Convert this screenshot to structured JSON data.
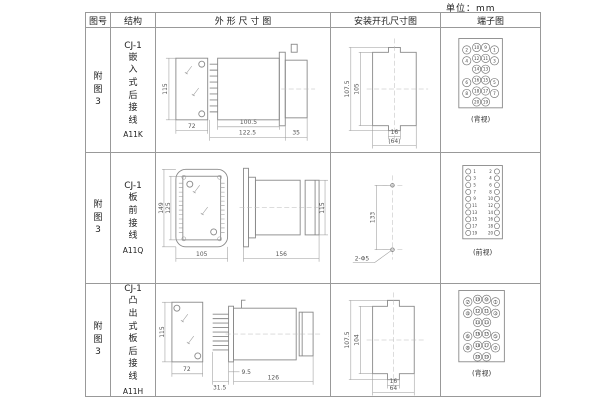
{
  "unit_label": "单位：mm",
  "table": {
    "headers": {
      "fig_no": "图号",
      "structure": "结构",
      "outline": "外 形 尺 寸 图",
      "install": "安装开孔尺寸图",
      "terminal": "端子图"
    },
    "rows": [
      {
        "fig_no": "附图3",
        "model": "CJ-1",
        "structure_desc": "嵌入式后接线",
        "code": "A11K",
        "outline": {
          "front_h": "115",
          "front_w": "72",
          "body_d": "100.5",
          "total_d": "122.5",
          "rear_d": "35"
        },
        "install": {
          "outer_h": "107.5",
          "inner_h": "105",
          "slot_w": "16",
          "cutout_w": "(64)"
        },
        "terminal": {
          "view_label": "(背视)",
          "type": "staggered",
          "screw": false,
          "rows": [
            [
              "2",
              "10",
              "9",
              "1"
            ],
            [
              "4",
              "12",
              "11",
              "3"
            ],
            [
              "",
              "14",
              "13",
              ""
            ],
            [
              "6",
              "16",
              "15",
              "5"
            ],
            [
              "8",
              "18",
              "17",
              "7"
            ],
            [
              "",
              "20",
              "19",
              ""
            ]
          ]
        }
      },
      {
        "fig_no": "附图3",
        "model": "CJ-1",
        "structure_desc": "板前接线",
        "code": "A11Q",
        "outline": {
          "front_outer_h": "149",
          "front_inner_h": "125",
          "front_w": "105",
          "side_l": "156",
          "side_h": "115"
        },
        "install": {
          "hole_spacing": "133",
          "hole_label": "2-Φ5"
        },
        "terminal": {
          "view_label": "(前视)",
          "type": "dual",
          "left": [
            "1",
            "3",
            "5",
            "7",
            "9",
            "11",
            "13",
            "15",
            "17",
            "19"
          ],
          "right": [
            "2",
            "4",
            "6",
            "8",
            "10",
            "12",
            "14",
            "16",
            "18",
            "20"
          ]
        }
      },
      {
        "fig_no": "附图3",
        "model": "CJ-1",
        "structure_desc": "凸出式板后接线",
        "code": "A11H",
        "outline": {
          "front_h": "115",
          "front_w": "72",
          "pin_l": "31.5",
          "plate_d": "9.5",
          "body_d": "126"
        },
        "install": {
          "outer_h": "107.5",
          "inner_h": "104",
          "slot_w": "16",
          "cutout_w": "64"
        },
        "terminal": {
          "view_label": "(背视)",
          "type": "staggered",
          "screw": true,
          "rows": [
            [
              "2",
              "10",
              "9",
              "1"
            ],
            [
              "4",
              "12",
              "11",
              "3"
            ],
            [
              "",
              "14",
              "13",
              ""
            ],
            [
              "6",
              "16",
              "15",
              "5"
            ],
            [
              "8",
              "18",
              "17",
              "7"
            ],
            [
              "",
              "20",
              "19",
              ""
            ]
          ]
        }
      }
    ]
  }
}
